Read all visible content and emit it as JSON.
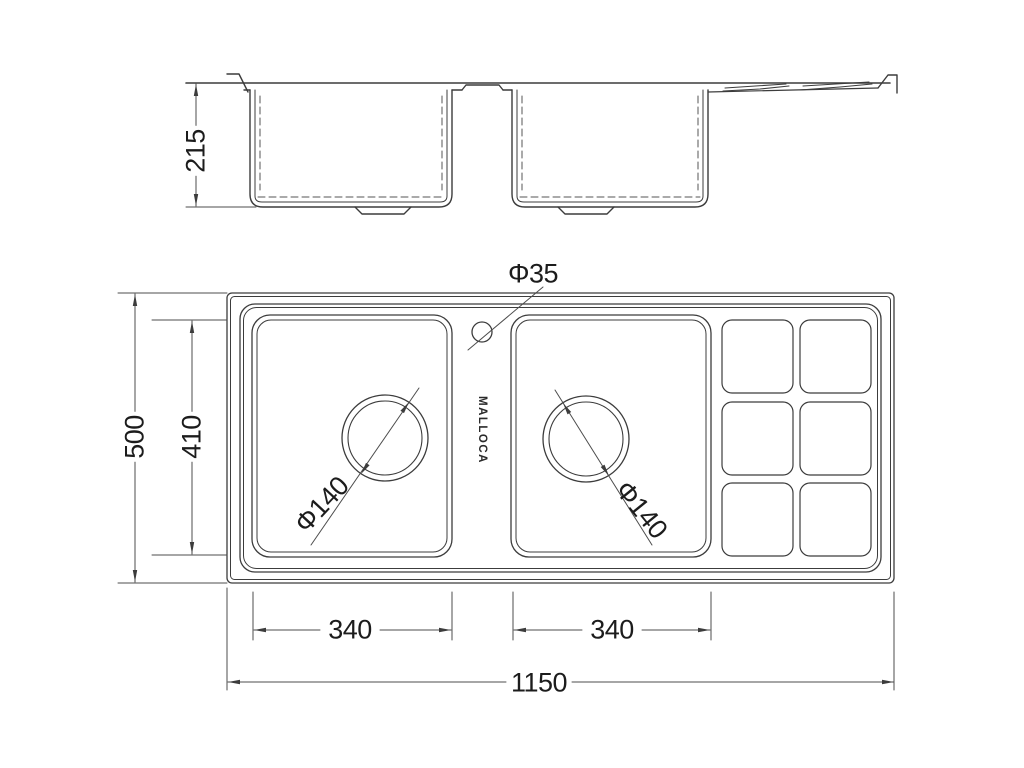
{
  "brand": "MALLOCA",
  "dimensions": {
    "bowl_depth_side": "215",
    "overall_depth": "500",
    "inner_depth": "410",
    "bowl_left_width": "340",
    "bowl_right_width": "340",
    "overall_width": "1150",
    "faucet_hole_diameter": "Φ35",
    "drain_left_diameter": "Φ140",
    "drain_right_diameter": "Φ140"
  }
}
